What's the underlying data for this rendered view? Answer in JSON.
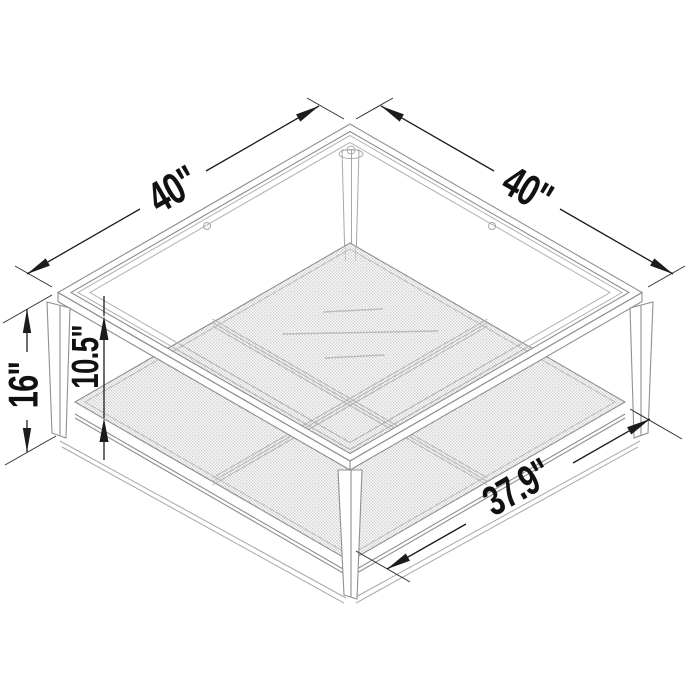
{
  "diagram": {
    "dimensions": {
      "top_side_left": "40\"",
      "top_side_right": "40\"",
      "overall_height": "16\"",
      "shelf_clearance": "10.5\"",
      "shelf_width": "37.9\""
    }
  }
}
